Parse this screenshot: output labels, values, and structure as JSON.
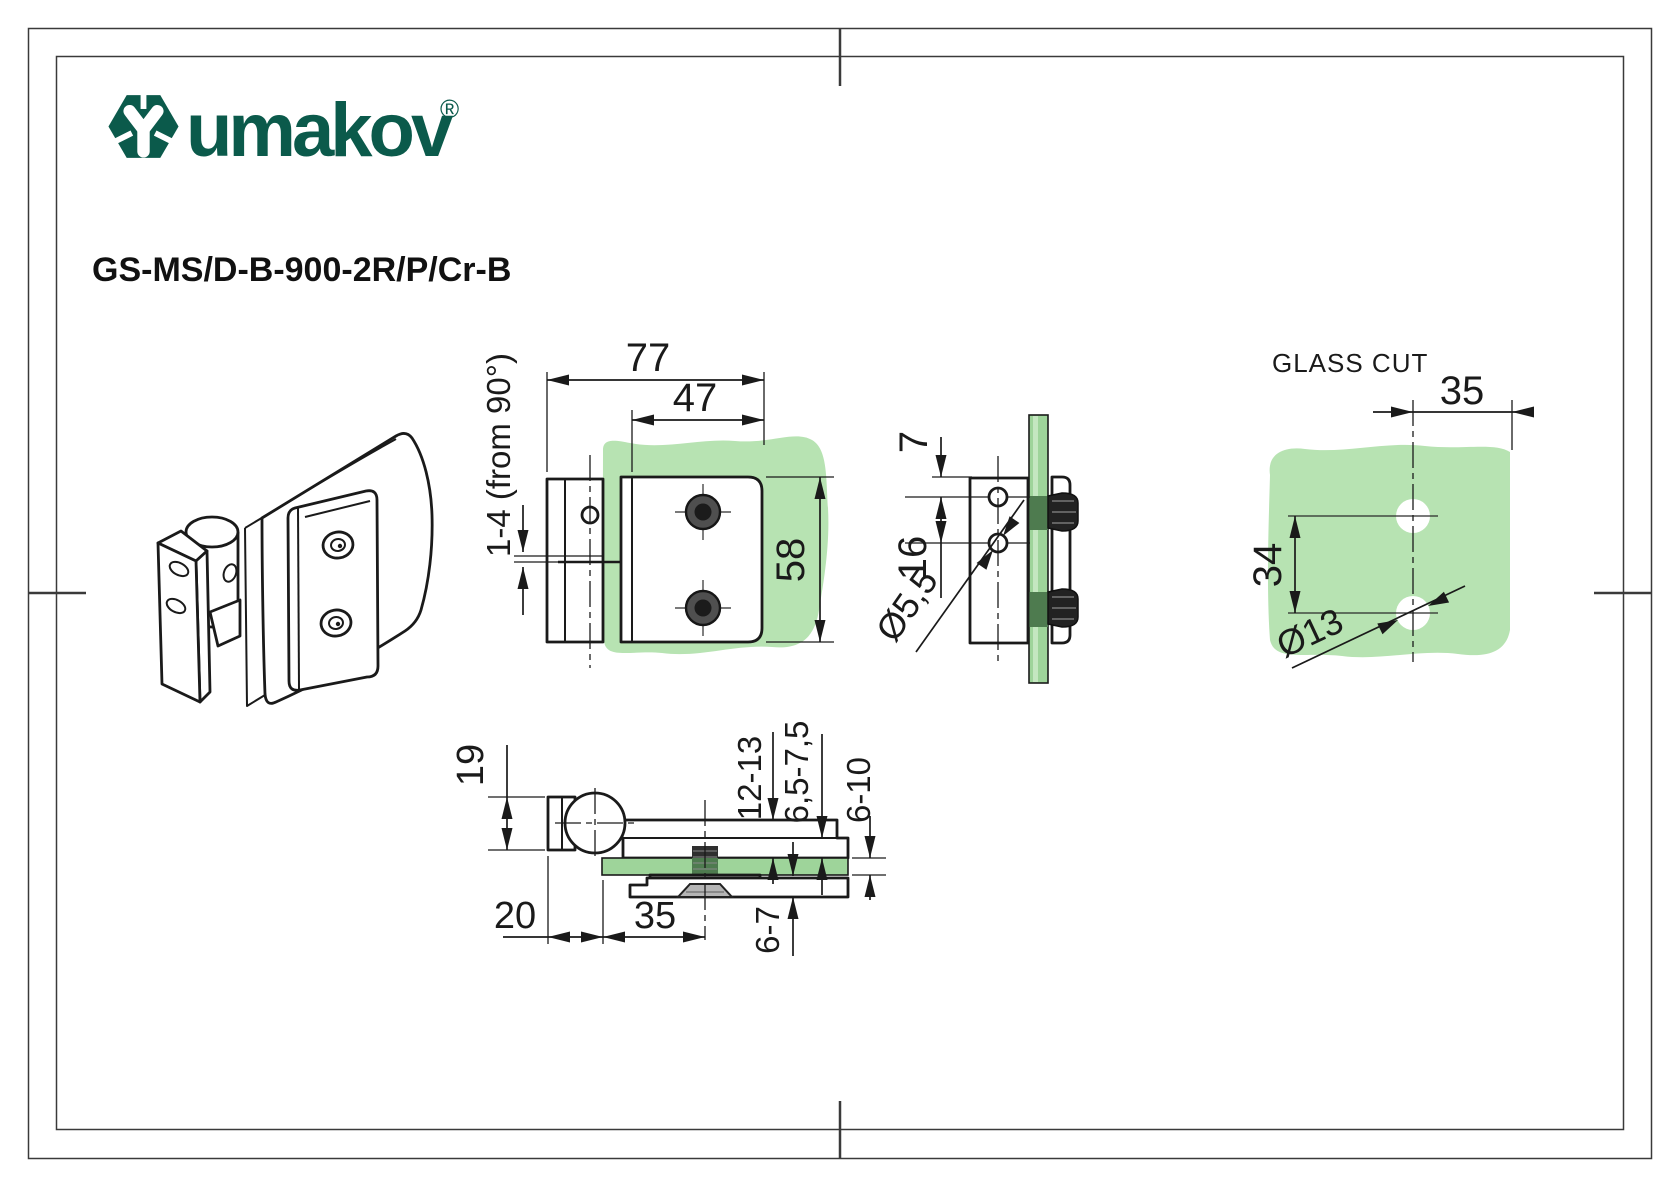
{
  "header": {
    "brand": "umakov",
    "registered_mark": "®",
    "product_code": "GS-MS/D-B-900-2R/P/Cr-B"
  },
  "colors": {
    "brand_green": "#0b5a4b",
    "glass_light": "#b7e3b2",
    "glass_mid": "#9ed49a",
    "glass_dark": "#4e7b4f",
    "line_color": "#1a1a1a"
  },
  "views": {
    "front": {
      "dim_total_width": "77",
      "dim_plate_width": "47",
      "dim_plate_height": "58",
      "dim_adjustment": "1-4 (from 90°)"
    },
    "side": {
      "dim_hole_top_offset": "7",
      "dim_hole_spacing": "16",
      "dim_hole_diameter": "Ø5,5"
    },
    "glass_cut": {
      "title": "GLASS CUT",
      "dim_hole_edge_distance": "35",
      "dim_hole_spacing": "34",
      "dim_hole_diameter": "Ø13"
    },
    "bottom": {
      "dim_knuckle_depth": "19",
      "dim_knuckle_offset": "20",
      "dim_screw_distance": "35",
      "dim_clamp_range": "12-13",
      "dim_gap_range": "6,5-7,5",
      "dim_glass_thickness": "6-10",
      "dim_plate_thickness": "6-7"
    }
  }
}
